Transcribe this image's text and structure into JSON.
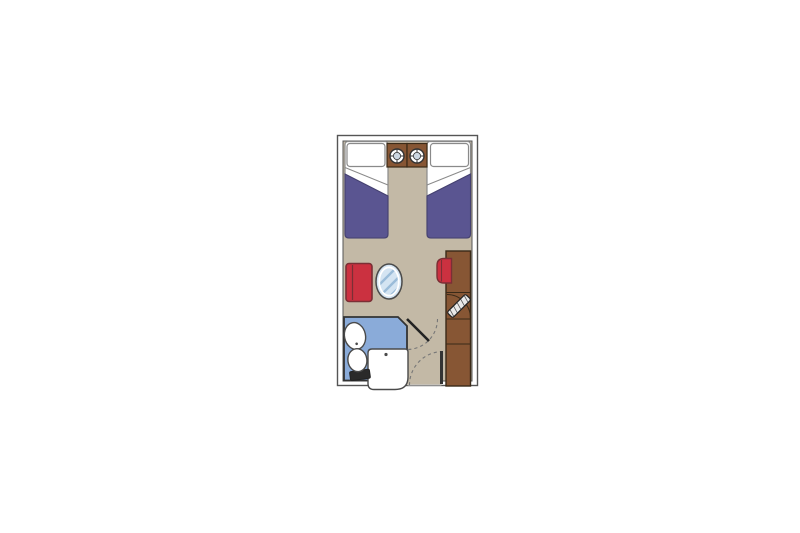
{
  "floorplan": {
    "type": "cruise-cabin-floor-plan",
    "icons": {
      "ceiling_lamp": "crosshair-circle-lamp"
    },
    "colors": {
      "page_bg": "#ffffff",
      "wall_fill": "#ffffff",
      "wall_outline": "#555555",
      "floor": "#c3b9a6",
      "bed_linen": "#ffffff",
      "bed_outline": "#8a8a8a",
      "bed_blanket": "#5a5591",
      "bed_blanket_outline": "#454170",
      "wood": "#875634",
      "wood_dark": "#3a2a18",
      "seat_red": "#cb3140",
      "seat_red_dark": "#7b2f35",
      "bath_floor": "#8aabd9",
      "bath_outline": "#333333",
      "fixture_white": "#ffffff",
      "fixture_outline": "#4a4a4a",
      "tank_dark": "#2a2a2a",
      "glass": "#d4e4f2",
      "glass_hatch": "#9bbcd9",
      "glass_ring": "#ffffff",
      "lamp_inner": "#ccd7e2",
      "lamp_outline": "#333333",
      "door_leaf": "#222222",
      "door_dash": "#777777",
      "threshold": "#c9c9c9",
      "tv_screen": "#e9e9e9",
      "tv_hatch": "#555555"
    }
  }
}
